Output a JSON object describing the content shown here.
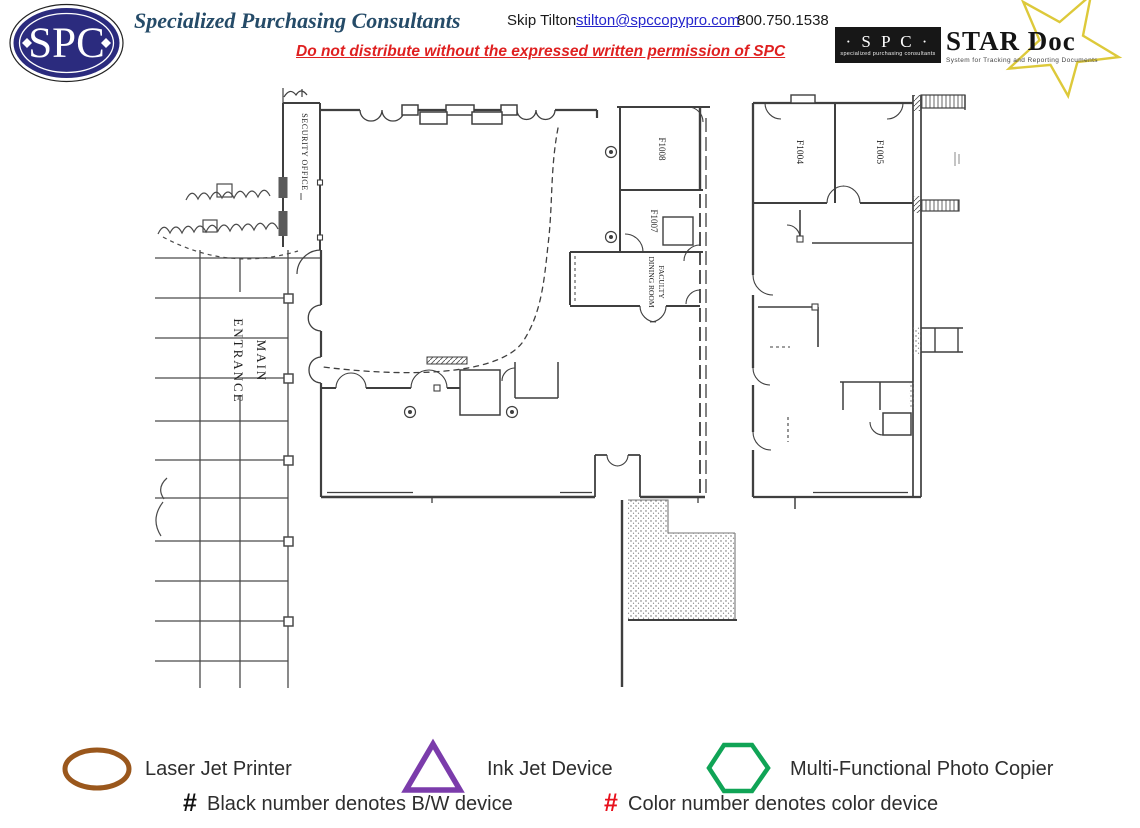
{
  "header": {
    "logo_text": "SPC",
    "company": "Specialized Purchasing Consultants",
    "contact_name": "Skip Tilton",
    "contact_email": "stilton@spccopypro.com",
    "contact_phone": "800.750.1538",
    "warning": "Do not distribute without the expressed written permission of SPC",
    "stardoc": {
      "badge": "· S P C ·",
      "badge_sub": "specialized purchasing consultants",
      "title": "STAR Doc",
      "subtitle": "System for Tracking and Reporting Documents",
      "star_color": "#ddc93a"
    }
  },
  "floorplan": {
    "labels": {
      "security_office": "SECURITY OFFICE",
      "main_entrance_line1": "MAIN",
      "main_entrance_line2": "ENTRANCE",
      "room_f1008": "F1008",
      "room_f1007": "F1007",
      "faculty_dining_line1": "FACULTY",
      "faculty_dining_line2": "DINING ROOM",
      "room_f1004": "F1004",
      "room_f1005": "F1005"
    }
  },
  "legend": {
    "items": [
      {
        "shape": "oval",
        "color": "#9a571c",
        "label": "Laser Jet Printer"
      },
      {
        "shape": "triangle",
        "color": "#7b3cab",
        "label": "Ink Jet Device"
      },
      {
        "shape": "hexagon",
        "color": "#10a456",
        "label": "Multi-Functional Photo Copier"
      }
    ],
    "notes": [
      {
        "symbol": "#",
        "color": "#111111",
        "label": "Black number denotes B/W device"
      },
      {
        "symbol": "#",
        "color": "#e8101c",
        "label": "Color number denotes color device"
      }
    ]
  }
}
